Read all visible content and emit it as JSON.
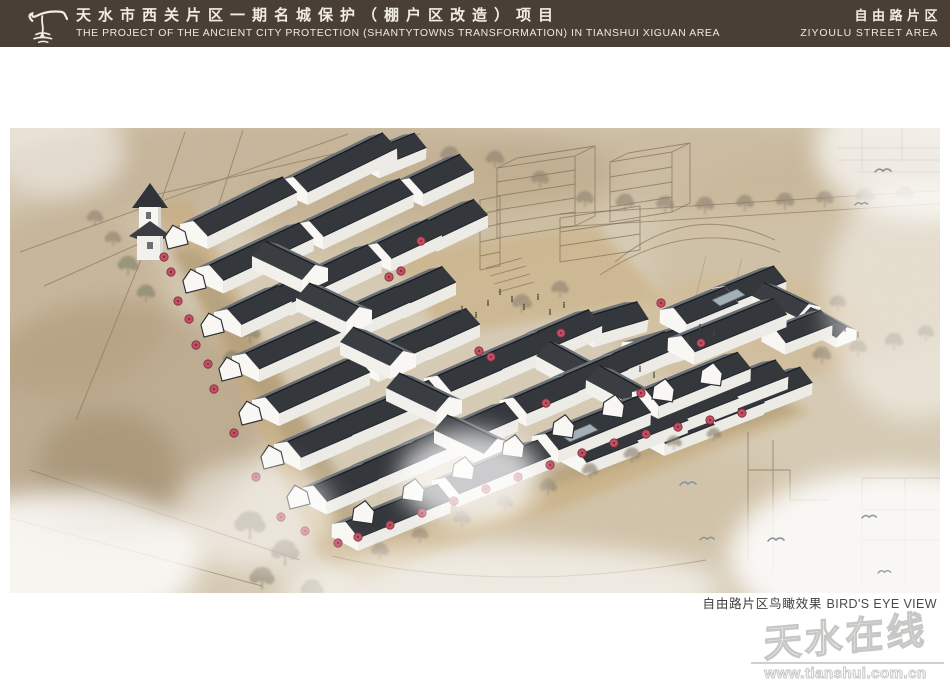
{
  "header": {
    "title_zh": "天水市西关片区一期名城保护（棚户区改造）项目",
    "title_en": "THE PROJECT OF THE ANCIENT CITY PROTECTION (SHANTYTOWNS TRANSFORMATION) IN TIANSHUI XIGUAN AREA",
    "area_zh": "自由路片区",
    "area_en": "ZIYOULU STREET AREA",
    "bg_color": "#493f36",
    "text_color": "#f2ede3"
  },
  "rendering": {
    "type": "architectural bird's-eye perspective rendering",
    "caption_zh": "自由路片区鸟瞰效果",
    "caption_en": "BIRD'S EYE VIEW",
    "palette": {
      "ground_wash": "#d8cdb7",
      "street_tan": "#c8ab7c",
      "roof_dark": "#34373c",
      "roof_light": "#6b7177",
      "wall_white": "#f8f7f3",
      "umbrella_red": "#c24f63",
      "sketch_line": "#8a7456"
    }
  },
  "watermark": {
    "name": "天水在线",
    "url": "www.tianshui.com.cn"
  }
}
